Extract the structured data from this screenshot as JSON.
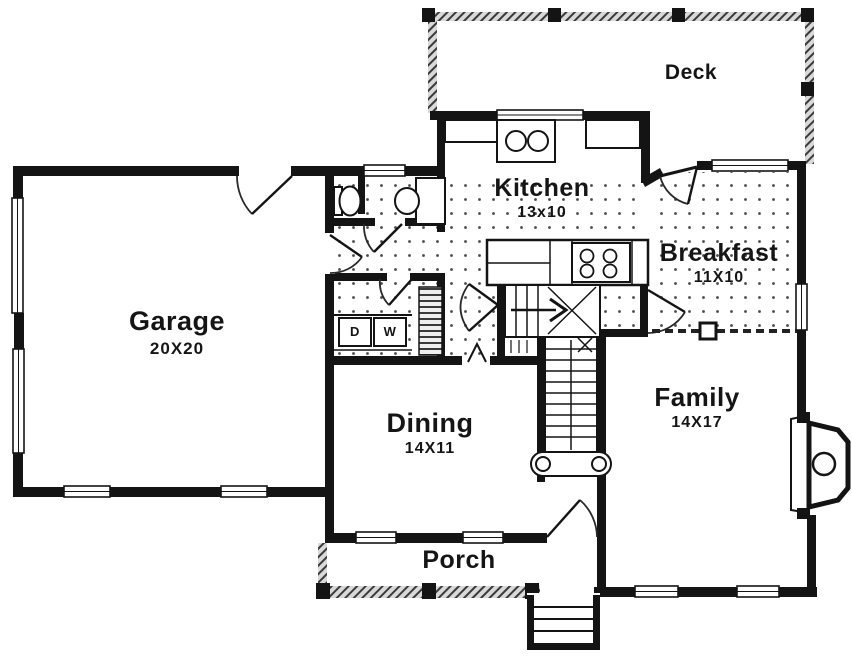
{
  "rooms": {
    "deck": {
      "label": "Deck"
    },
    "kitchen": {
      "label": "Kitchen",
      "size": "13x10"
    },
    "breakfast": {
      "label": "Breakfast",
      "size": "11X10"
    },
    "garage": {
      "label": "Garage",
      "size": "20X20"
    },
    "dining": {
      "label": "Dining",
      "size": "14X11"
    },
    "family": {
      "label": "Family",
      "size": "14X17"
    },
    "porch": {
      "label": "Porch"
    }
  },
  "laundry": {
    "dryer_label": "D",
    "washer_label": "W"
  },
  "colors": {
    "wall": "#141414",
    "floor_dot": "#4a4a4a",
    "background": "#ffffff",
    "railing_fill": "#d9d9d9"
  }
}
